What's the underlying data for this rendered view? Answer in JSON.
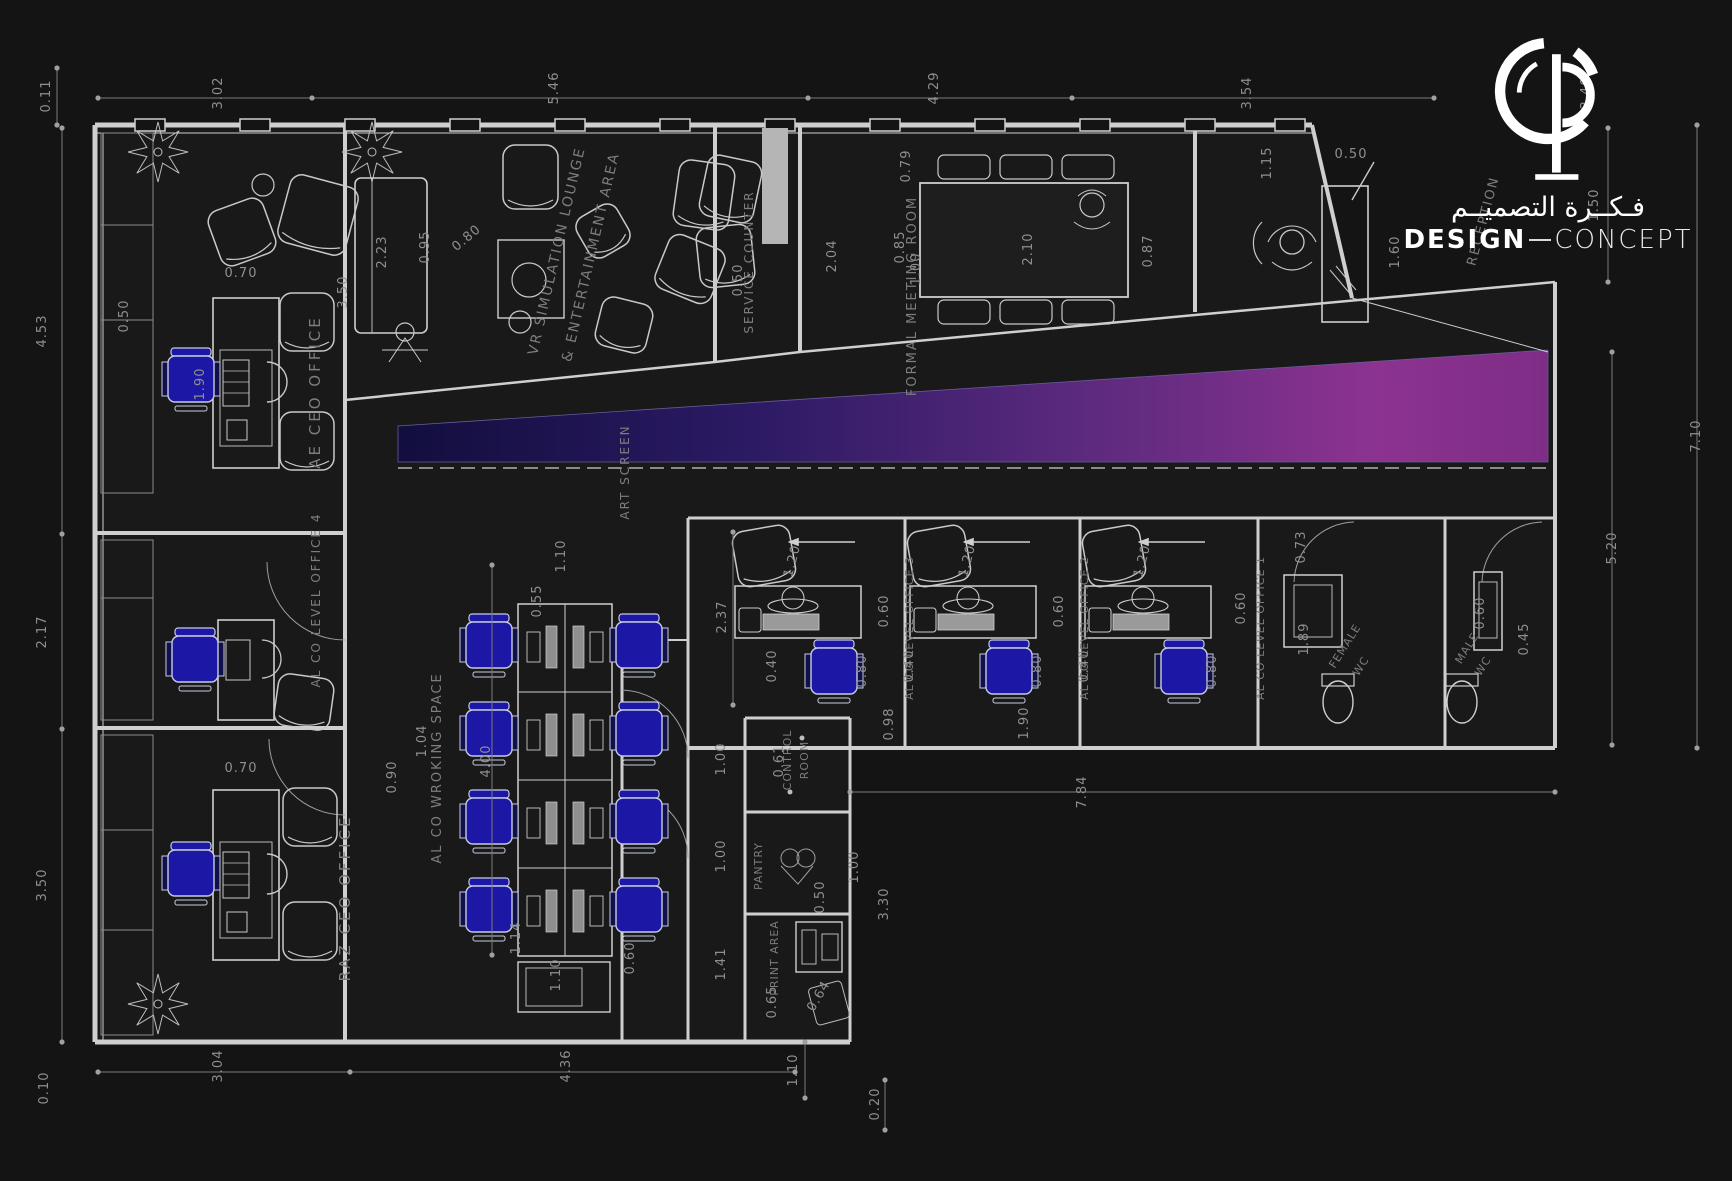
{
  "logo": {
    "arabic": "فـكــرة التصميــم",
    "en_primary": "DESIGN",
    "en_secondary": "CONCEPT"
  },
  "colors": {
    "background": "#141414",
    "wall_line": "#cfcfcf",
    "dim_text": "#8f8f8f",
    "label_text": "#7d7d7d",
    "chair_fill": "#1c17a5",
    "panel_gray": "#b5b5b5",
    "band_gradient": [
      "#120e3e",
      "#2b1a63",
      "#5c2a7e",
      "#8c3390",
      "#7e2d86"
    ]
  },
  "room_labels": [
    {
      "id": "ae-ceo-office",
      "text": "AE CEO OFFICE",
      "x": 320,
      "y": 392,
      "r": -90,
      "fs": 15,
      "ls": 3
    },
    {
      "id": "vr-lounge-line1",
      "text": "VR SIMULATION LOUNGE",
      "x": 561,
      "y": 252,
      "r": -77,
      "fs": 14,
      "ls": 2
    },
    {
      "id": "vr-lounge-line2",
      "text": "& ENTERTAINMENT AREA",
      "x": 595,
      "y": 258,
      "r": -77,
      "fs": 14,
      "ls": 2
    },
    {
      "id": "service-counter",
      "text": "SERVICE COUNTER",
      "x": 753,
      "y": 262,
      "r": -90,
      "fs": 12,
      "ls": 2
    },
    {
      "id": "formal-meeting-room",
      "text": "FORMAL MEETING ROOM",
      "x": 916,
      "y": 296,
      "r": -90,
      "fs": 13,
      "ls": 2
    },
    {
      "id": "reception",
      "text": "RECEPTION",
      "x": 1487,
      "y": 222,
      "r": -75,
      "fs": 13,
      "ls": 2
    },
    {
      "id": "art-screen",
      "text": "ART SCREEN",
      "x": 629,
      "y": 472,
      "r": -90,
      "fs": 12,
      "ls": 2
    },
    {
      "id": "office-4",
      "text": "AL CO LEVEL OFFICE 4",
      "x": 320,
      "y": 600,
      "r": -90,
      "fs": 12,
      "ls": 2
    },
    {
      "id": "raz-ceo-office",
      "text": "RAZ CEO OFFICE",
      "x": 350,
      "y": 898,
      "r": -90,
      "fs": 15,
      "ls": 3
    },
    {
      "id": "working-space",
      "text": "AL CO WROKING SPACE",
      "x": 441,
      "y": 768,
      "r": -90,
      "fs": 13,
      "ls": 2
    },
    {
      "id": "office-3",
      "text": "AL CO LEVEL OFFICE 3",
      "x": 913,
      "y": 628,
      "r": -90,
      "fs": 11,
      "ls": 1
    },
    {
      "id": "office-2",
      "text": "AL CO LEVEL OFFICE 2",
      "x": 1088,
      "y": 628,
      "r": -90,
      "fs": 11,
      "ls": 1
    },
    {
      "id": "office-1",
      "text": "AL CO LEVEL OFFICE 1",
      "x": 1264,
      "y": 628,
      "r": -90,
      "fs": 11,
      "ls": 1
    },
    {
      "id": "control-room-line1",
      "text": "CONTROL",
      "x": 791,
      "y": 760,
      "r": -90,
      "fs": 11,
      "ls": 1
    },
    {
      "id": "control-room-line2",
      "text": "ROOM",
      "x": 808,
      "y": 760,
      "r": -90,
      "fs": 11,
      "ls": 1
    },
    {
      "id": "pantry",
      "text": "PANTRY",
      "x": 762,
      "y": 866,
      "r": -90,
      "fs": 11,
      "ls": 1
    },
    {
      "id": "print-area",
      "text": "PRINT AREA",
      "x": 778,
      "y": 958,
      "r": -90,
      "fs": 11,
      "ls": 1
    },
    {
      "id": "female-wc-line1",
      "text": "FEMALE",
      "x": 1348,
      "y": 648,
      "r": -58,
      "fs": 11,
      "ls": 1
    },
    {
      "id": "female-wc-line2",
      "text": "WC",
      "x": 1364,
      "y": 668,
      "r": -58,
      "fs": 11,
      "ls": 1
    },
    {
      "id": "male-wc-line1",
      "text": "MALE",
      "x": 1470,
      "y": 650,
      "r": -58,
      "fs": 11,
      "ls": 1
    },
    {
      "id": "male-wc-line2",
      "text": "WC",
      "x": 1486,
      "y": 668,
      "r": -58,
      "fs": 11,
      "ls": 1
    }
  ],
  "dimensions": [
    {
      "v": "0.11",
      "x": 50,
      "y": 96
    },
    {
      "v": "3.02",
      "x": 222,
      "y": 93
    },
    {
      "v": "5.46",
      "x": 558,
      "y": 88
    },
    {
      "v": "4.29",
      "x": 938,
      "y": 88
    },
    {
      "v": "3.54",
      "x": 1251,
      "y": 93
    },
    {
      "v": "3.40",
      "x": 1590,
      "y": 93
    },
    {
      "v": "1.50",
      "x": 1598,
      "y": 205
    },
    {
      "v": "4.53",
      "x": 46,
      "y": 331
    },
    {
      "v": "2.17",
      "x": 46,
      "y": 632
    },
    {
      "v": "3.50",
      "x": 46,
      "y": 885
    },
    {
      "v": "0.10",
      "x": 48,
      "y": 1088
    },
    {
      "v": "7.10",
      "x": 1700,
      "y": 436
    },
    {
      "v": "5.20",
      "x": 1616,
      "y": 548
    },
    {
      "v": "3.04",
      "x": 222,
      "y": 1066
    },
    {
      "v": "4.36",
      "x": 570,
      "y": 1066
    },
    {
      "v": "1.10",
      "x": 797,
      "y": 1070
    },
    {
      "v": "0.20",
      "x": 879,
      "y": 1104
    },
    {
      "v": "7.84",
      "x": 1086,
      "y": 792
    },
    {
      "v": "0.50",
      "x": 128,
      "y": 316
    },
    {
      "v": "0.70",
      "x": 241,
      "y": 277,
      "r": 0
    },
    {
      "v": "1.90",
      "x": 204,
      "y": 384
    },
    {
      "v": "0.70",
      "x": 241,
      "y": 772,
      "r": 0
    },
    {
      "v": "2.23",
      "x": 386,
      "y": 252
    },
    {
      "v": "0.95",
      "x": 429,
      "y": 247
    },
    {
      "v": "0.80",
      "x": 469,
      "y": 241,
      "r": -40
    },
    {
      "v": "3.50",
      "x": 347,
      "y": 292
    },
    {
      "v": "0.50",
      "x": 742,
      "y": 280
    },
    {
      "v": "2.04",
      "x": 836,
      "y": 256
    },
    {
      "v": "0.79",
      "x": 910,
      "y": 166
    },
    {
      "v": "0.85",
      "x": 904,
      "y": 247
    },
    {
      "v": "1.00",
      "x": 920,
      "y": 269
    },
    {
      "v": "2.10",
      "x": 1032,
      "y": 249
    },
    {
      "v": "0.87",
      "x": 1152,
      "y": 251
    },
    {
      "v": "1.15",
      "x": 1271,
      "y": 163
    },
    {
      "v": "0.50",
      "x": 1351,
      "y": 158,
      "r": 0
    },
    {
      "v": "1.60",
      "x": 1399,
      "y": 252
    },
    {
      "v": "0.55",
      "x": 541,
      "y": 601
    },
    {
      "v": "1.10",
      "x": 565,
      "y": 556
    },
    {
      "v": "0.90",
      "x": 396,
      "y": 777
    },
    {
      "v": "1.04",
      "x": 426,
      "y": 741
    },
    {
      "v": "4.00",
      "x": 490,
      "y": 761
    },
    {
      "v": "1.14",
      "x": 520,
      "y": 938
    },
    {
      "v": "1.10",
      "x": 560,
      "y": 975
    },
    {
      "v": "0.60",
      "x": 634,
      "y": 958
    },
    {
      "v": "2.37",
      "x": 726,
      "y": 617
    },
    {
      "v": "1.20",
      "x": 796,
      "y": 562,
      "r": -75
    },
    {
      "v": "1.20",
      "x": 971,
      "y": 562,
      "r": -75
    },
    {
      "v": "1.20",
      "x": 1146,
      "y": 562,
      "r": -75
    },
    {
      "v": "0.60",
      "x": 888,
      "y": 611
    },
    {
      "v": "0.60",
      "x": 1063,
      "y": 611
    },
    {
      "v": "0.60",
      "x": 1245,
      "y": 608
    },
    {
      "v": "0.40",
      "x": 776,
      "y": 666
    },
    {
      "v": "0.40",
      "x": 913,
      "y": 666
    },
    {
      "v": "0.40",
      "x": 1088,
      "y": 666
    },
    {
      "v": "0.80",
      "x": 866,
      "y": 671
    },
    {
      "v": "0.80",
      "x": 1041,
      "y": 671
    },
    {
      "v": "0.80",
      "x": 1216,
      "y": 671
    },
    {
      "v": "0.98",
      "x": 893,
      "y": 724
    },
    {
      "v": "1.90",
      "x": 1028,
      "y": 723
    },
    {
      "v": "0.73",
      "x": 1305,
      "y": 547
    },
    {
      "v": "1.89",
      "x": 1308,
      "y": 639
    },
    {
      "v": "0.60",
      "x": 1484,
      "y": 613
    },
    {
      "v": "0.45",
      "x": 1528,
      "y": 639
    },
    {
      "v": "1.00",
      "x": 725,
      "y": 759
    },
    {
      "v": "1.00",
      "x": 725,
      "y": 856
    },
    {
      "v": "0.61",
      "x": 783,
      "y": 761
    },
    {
      "v": "0.50",
      "x": 824,
      "y": 897
    },
    {
      "v": "1.00",
      "x": 858,
      "y": 867
    },
    {
      "v": "3.30",
      "x": 888,
      "y": 904
    },
    {
      "v": "1.41",
      "x": 725,
      "y": 964
    },
    {
      "v": "0.65",
      "x": 776,
      "y": 1002
    },
    {
      "v": "0.64",
      "x": 822,
      "y": 998,
      "r": -60
    }
  ]
}
